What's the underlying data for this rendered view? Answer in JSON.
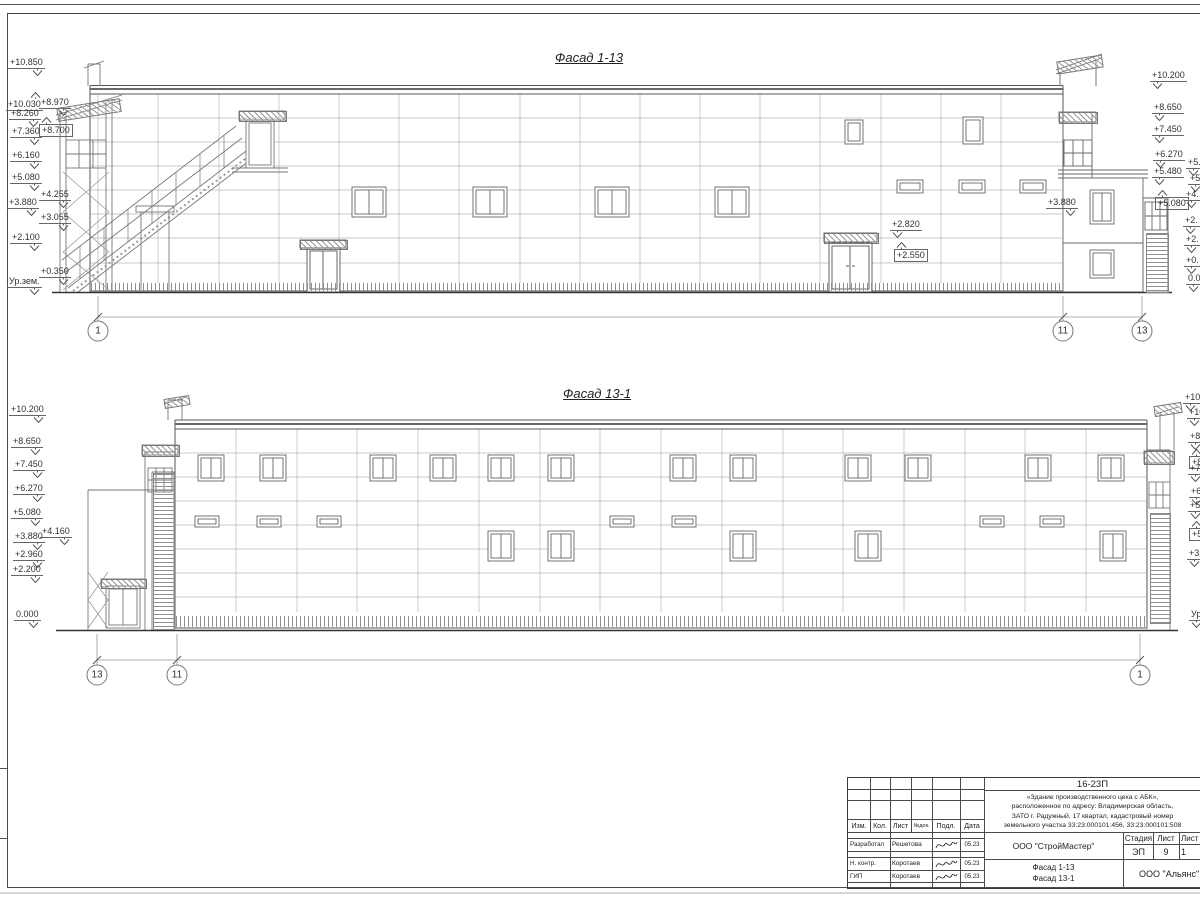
{
  "facade1": {
    "title": "Фасад 1-13",
    "marks": [
      {
        "t": "+10.850",
        "x": 8,
        "y": 57
      },
      {
        "t": "+10.030",
        "x": 6,
        "y": 92,
        "cls": "up"
      },
      {
        "t": "+8.970",
        "x": 39,
        "y": 97
      },
      {
        "t": "+8.260",
        "x": 9,
        "y": 108
      },
      {
        "t": "+8.700",
        "x": 39,
        "y": 117,
        "cls": "fl-l boxed up"
      },
      {
        "t": "+7.360",
        "x": 10,
        "y": 126
      },
      {
        "t": "+6.160",
        "x": 10,
        "y": 150
      },
      {
        "t": "+5.080",
        "x": 10,
        "y": 172
      },
      {
        "t": "+4.255",
        "x": 39,
        "y": 189
      },
      {
        "t": "+3.880",
        "x": 7,
        "y": 197
      },
      {
        "t": "+3.055",
        "x": 39,
        "y": 212
      },
      {
        "t": "+2.100",
        "x": 10,
        "y": 232
      },
      {
        "t": "+0.350",
        "x": 39,
        "y": 266
      },
      {
        "t": "Ур.зем.",
        "x": 7,
        "y": 276
      },
      {
        "t": "+10.200",
        "x": 1150,
        "y": 70,
        "cls": "fl-l"
      },
      {
        "t": "+8.650",
        "x": 1152,
        "y": 102,
        "cls": "fl-l"
      },
      {
        "t": "+7.450",
        "x": 1152,
        "y": 124,
        "cls": "fl-l"
      },
      {
        "t": "+6.270",
        "x": 1153,
        "y": 149,
        "cls": "fl-l"
      },
      {
        "t": "+5.480",
        "x": 1152,
        "y": 166,
        "cls": "fl-l"
      },
      {
        "t": "+5.080",
        "x": 1155,
        "y": 190,
        "cls": "fl-l boxed up"
      },
      {
        "t": "+5.",
        "x": 1186,
        "y": 157,
        "cls": "fl-l"
      },
      {
        "t": "+5.",
        "x": 1188,
        "y": 173,
        "cls": "fl-l"
      },
      {
        "t": "+4.",
        "x": 1184,
        "y": 189,
        "cls": "fl-l"
      },
      {
        "t": "+2.",
        "x": 1183,
        "y": 215,
        "cls": "fl-l"
      },
      {
        "t": "+2.",
        "x": 1184,
        "y": 234,
        "cls": "fl-l"
      },
      {
        "t": "+0.",
        "x": 1184,
        "y": 255,
        "cls": "fl-l"
      },
      {
        "t": "0.0",
        "x": 1186,
        "y": 273,
        "cls": "fl-l"
      },
      {
        "t": "+2.820",
        "x": 890,
        "y": 219,
        "cls": "fl-l"
      },
      {
        "t": "+2.550",
        "x": 894,
        "y": 242,
        "cls": "fl-l boxed up"
      },
      {
        "t": "+3.880",
        "x": 1046,
        "y": 197
      }
    ],
    "dims": [
      {
        "t": "48000",
        "x": 562,
        "y": 305
      },
      {
        "t": "3920",
        "x": 1086,
        "y": 305,
        "cls": "gray"
      }
    ],
    "axes": [
      {
        "t": "1",
        "x": 98,
        "y": 331
      },
      {
        "t": "11",
        "x": 1063,
        "y": 331
      },
      {
        "t": "13",
        "x": 1142,
        "y": 331
      }
    ]
  },
  "facade2": {
    "title": "Фасад 13-1",
    "marks": [
      {
        "t": "+10.200",
        "x": 9,
        "y": 404
      },
      {
        "t": "+8.650",
        "x": 11,
        "y": 436
      },
      {
        "t": "+7.450",
        "x": 13,
        "y": 459
      },
      {
        "t": "+6.270",
        "x": 13,
        "y": 483
      },
      {
        "t": "+5.080",
        "x": 11,
        "y": 507
      },
      {
        "t": "+4.160",
        "x": 40,
        "y": 526
      },
      {
        "t": "+3.880",
        "x": 13,
        "y": 531
      },
      {
        "t": "+2.960",
        "x": 13,
        "y": 549
      },
      {
        "t": "+2.200",
        "x": 11,
        "y": 564
      },
      {
        "t": "0.000",
        "x": 14,
        "y": 609
      },
      {
        "t": "+10.",
        "x": 1183,
        "y": 392,
        "cls": "fl-l"
      },
      {
        "t": "+10.",
        "x": 1187,
        "y": 407,
        "cls": "fl-l"
      },
      {
        "t": "+8.",
        "x": 1188,
        "y": 431,
        "cls": "fl-l"
      },
      {
        "t": "+8.",
        "x": 1189,
        "y": 449,
        "cls": "fl-l boxed up"
      },
      {
        "t": "+7.",
        "x": 1188,
        "y": 463,
        "cls": "fl-l"
      },
      {
        "t": "+6.",
        "x": 1189,
        "y": 486,
        "cls": "fl-l"
      },
      {
        "t": "+5.",
        "x": 1188,
        "y": 500,
        "cls": "fl-l"
      },
      {
        "t": "+5.",
        "x": 1189,
        "y": 521,
        "cls": "fl-l boxed up"
      },
      {
        "t": "+3.",
        "x": 1187,
        "y": 548,
        "cls": "fl-l"
      },
      {
        "t": "Ур.",
        "x": 1189,
        "y": 609,
        "cls": "fl-l"
      }
    ],
    "dims": [
      {
        "t": "3920",
        "x": 124,
        "y": 648,
        "cls": "gray"
      },
      {
        "t": "48000",
        "x": 640,
        "y": 648
      }
    ],
    "axes": [
      {
        "t": "13",
        "x": 97,
        "y": 675
      },
      {
        "t": "11",
        "x": 177,
        "y": 675
      },
      {
        "t": "1",
        "x": 1140,
        "y": 675
      }
    ]
  },
  "titleblock": {
    "code": "16-23П",
    "description": "«Здание производственного цеха с АБК»,\nрасположенное по адресу: Владимирская область,\nЗАТО г. Радужный, 17 квартал, кадастровый номер\nземельного участка 33:23:000101:456, 33:23:000101:508",
    "columns": [
      "Изм.",
      "Кол.",
      "Лист",
      "№док.",
      "Подл.",
      "Дата"
    ],
    "signs": [
      {
        "role": "Разработал",
        "name": "Решетова",
        "date": "05.23",
        "y": 60
      },
      {
        "role": "Н. контр.",
        "name": "Коротаев",
        "date": "05.23",
        "y": 79
      },
      {
        "role": "ГИП",
        "name": "Коротаев",
        "date": "05.23",
        "y": 92
      }
    ],
    "org": "ООО \"СтройМастер\"",
    "stage_label": "Стадия",
    "sheet_label": "Лист",
    "sheets_label": "Лист",
    "stage": "ЭП",
    "sheet": "9",
    "sheets": "1",
    "subject": "Фасад 1-13\nФасад 13-1",
    "contractor": "ООО \"Альянс\""
  }
}
